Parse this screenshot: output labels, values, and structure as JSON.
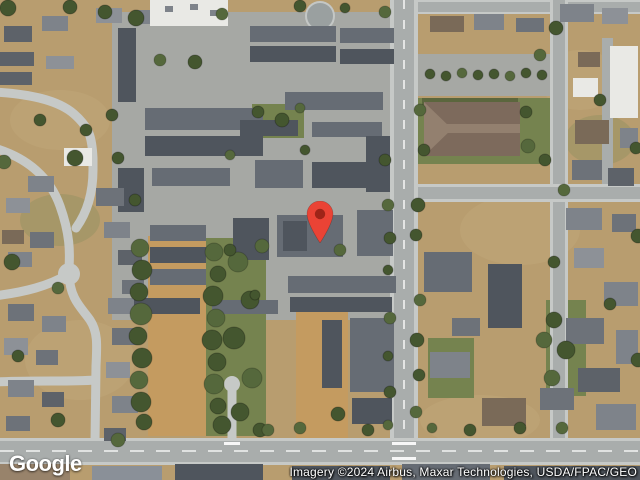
{
  "map": {
    "type": "satellite",
    "watermark": {
      "logo": "Google"
    },
    "attribution": {
      "text": "Imagery ©2024 Airbus, Maxar Technologies, USDA/FPAC/GEO"
    },
    "marker": {
      "x": 320,
      "y": 243,
      "width": 28,
      "height": 42
    }
  },
  "palette": {
    "base": "#b89d6f",
    "pave": "#a6a8a4",
    "grass": "#75834f",
    "dirt": "#c49b60",
    "road": "#a9adac",
    "roadLight": "#c6c9c7",
    "bld": "#666c74",
    "bldDark": "#4f555d",
    "bldLight": "#8a9098",
    "bldWhite": "#e9e9e5",
    "church": "#7d6a5c",
    "churchRidge": "#93806f",
    "tree": "#44562f",
    "tree2": "#55683c",
    "marker": "#EA4335",
    "markerDot": "#9E2418"
  }
}
